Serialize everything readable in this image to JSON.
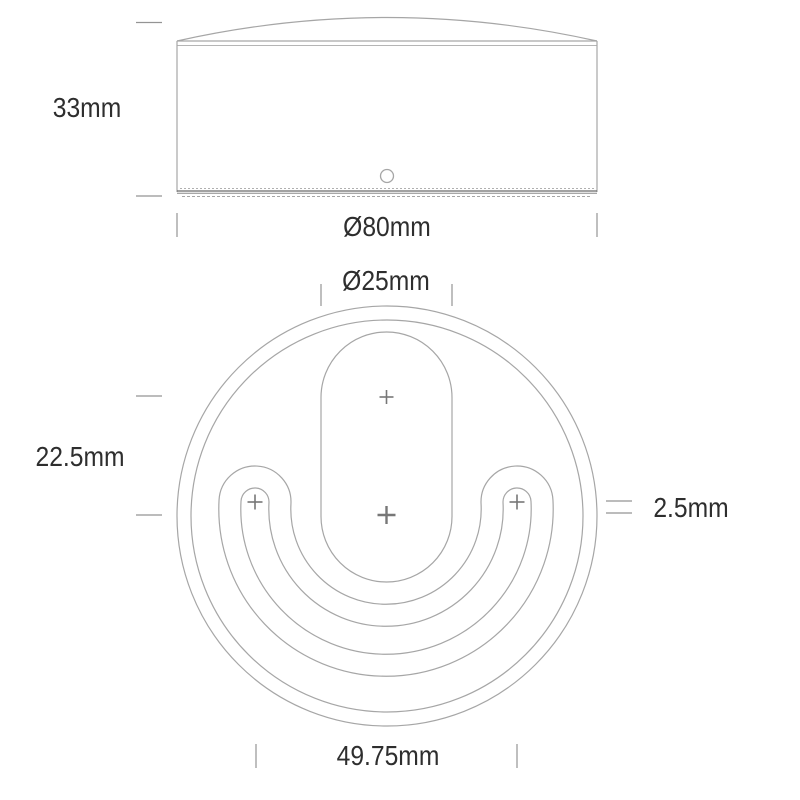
{
  "colors": {
    "background": "#ffffff",
    "drawing_line": "#a6a6a6",
    "drawing_line_light": "#b5b5b5",
    "drawing_line_dark": "#6a6a6a",
    "marker": "#777777",
    "tick": "#949494",
    "label_text": "#2e2e2e"
  },
  "side_view": {
    "height": "33mm",
    "diameter": "Ø80mm"
  },
  "bottom_view": {
    "slot_diameter": "Ø25mm",
    "vertical_hole_spacing": "22.5mm",
    "ring_gap": "2.5mm",
    "horizontal_hole_spacing": "49.75mm"
  }
}
